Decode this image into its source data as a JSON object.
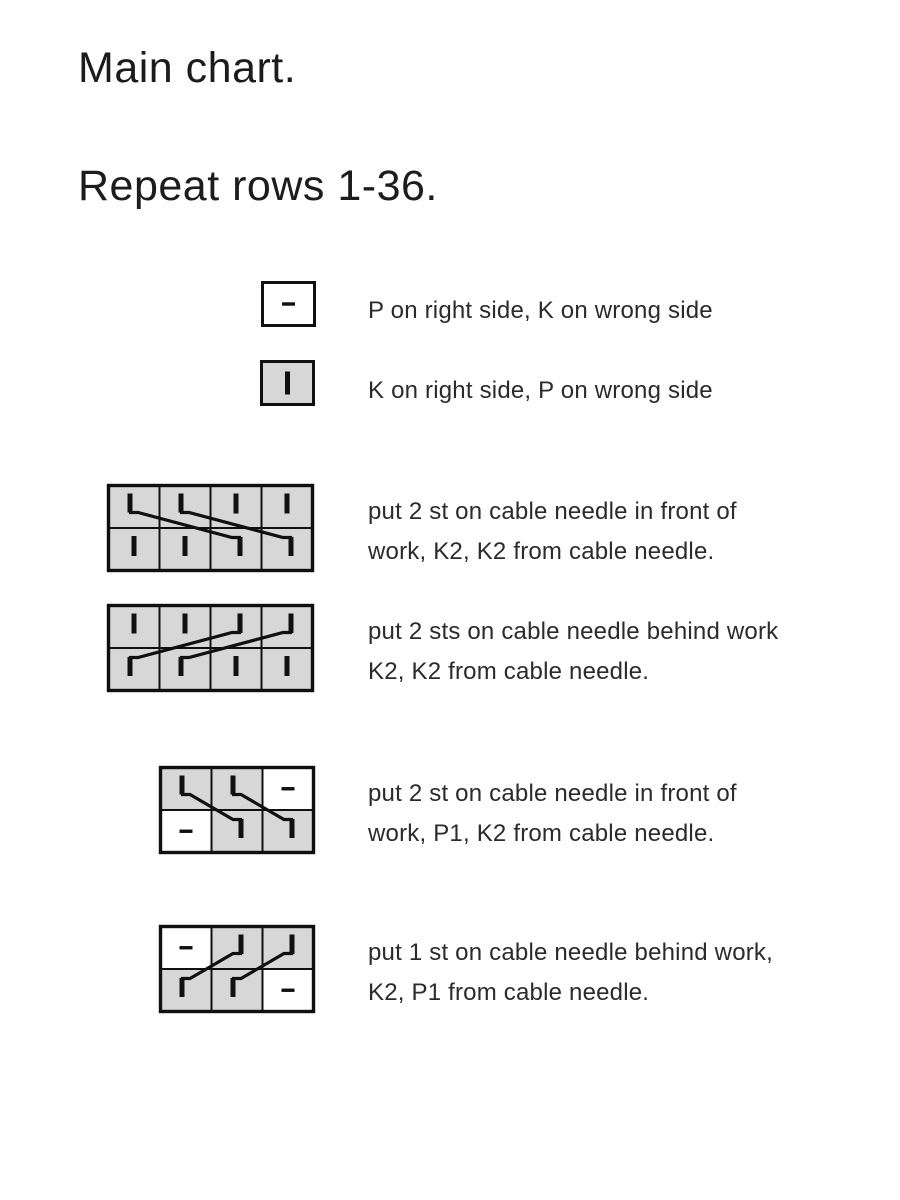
{
  "header": {
    "title": "Main chart.",
    "subtitle": "Repeat rows 1-36."
  },
  "colors": {
    "background": "#fefefe",
    "cell_gray": "#d7d7d7",
    "cell_white": "#ffffff",
    "line": "#101010",
    "text": "#2b2b2b",
    "title_text": "#1c1c1c"
  },
  "legend": [
    {
      "name": "purl",
      "lines": [
        "P on right side, K on wrong side"
      ],
      "symbol": {
        "kind": "single",
        "bg": "white",
        "glyph": "dash"
      }
    },
    {
      "name": "knit",
      "lines": [
        "K on right side, P on wrong side"
      ],
      "symbol": {
        "kind": "single",
        "bg": "gray",
        "glyph": "bar"
      }
    },
    {
      "name": "cable-4-front",
      "lines": [
        "put 2 st on cable needle in front of",
        "work, K2, K2 from cable needle."
      ],
      "symbol": {
        "kind": "grid",
        "cols": 4,
        "rows": 2,
        "cells": [
          [
            "cross",
            "cross",
            "bar",
            "bar"
          ],
          [
            "bar",
            "bar",
            "cross",
            "cross"
          ]
        ],
        "crosses": [
          {
            "dir": "front",
            "from": 0,
            "to": 2
          },
          {
            "dir": "front",
            "from": 1,
            "to": 3
          }
        ]
      }
    },
    {
      "name": "cable-4-back",
      "lines": [
        "put 2 sts on cable needle behind work",
        "K2, K2 from cable needle."
      ],
      "symbol": {
        "kind": "grid",
        "cols": 4,
        "rows": 2,
        "cells": [
          [
            "bar",
            "bar",
            "cross",
            "cross"
          ],
          [
            "cross",
            "cross",
            "bar",
            "bar"
          ]
        ],
        "crosses": [
          {
            "dir": "behind",
            "from": 0,
            "to": 2
          },
          {
            "dir": "behind",
            "from": 1,
            "to": 3
          }
        ]
      }
    },
    {
      "name": "cable-3-front-purl",
      "lines": [
        "put 2 st on cable needle in front of",
        "work, P1, K2 from cable needle."
      ],
      "symbol": {
        "kind": "grid",
        "cols": 3,
        "rows": 2,
        "cells": [
          [
            "cross",
            "cross",
            "dash"
          ],
          [
            "dash",
            "cross",
            "cross"
          ]
        ],
        "crosses": [
          {
            "dir": "front",
            "from": 0,
            "to": 1
          },
          {
            "dir": "front",
            "from": 1,
            "to": 2
          }
        ]
      }
    },
    {
      "name": "cable-3-back-purl",
      "lines": [
        "put 1 st on cable needle behind work,",
        "K2, P1 from cable needle."
      ],
      "symbol": {
        "kind": "grid",
        "cols": 3,
        "rows": 2,
        "cells": [
          [
            "dash",
            "cross",
            "cross"
          ],
          [
            "cross",
            "cross",
            "dash"
          ]
        ],
        "crosses": [
          {
            "dir": "behind",
            "from": 0,
            "to": 1
          },
          {
            "dir": "behind",
            "from": 1,
            "to": 2
          }
        ]
      }
    }
  ]
}
